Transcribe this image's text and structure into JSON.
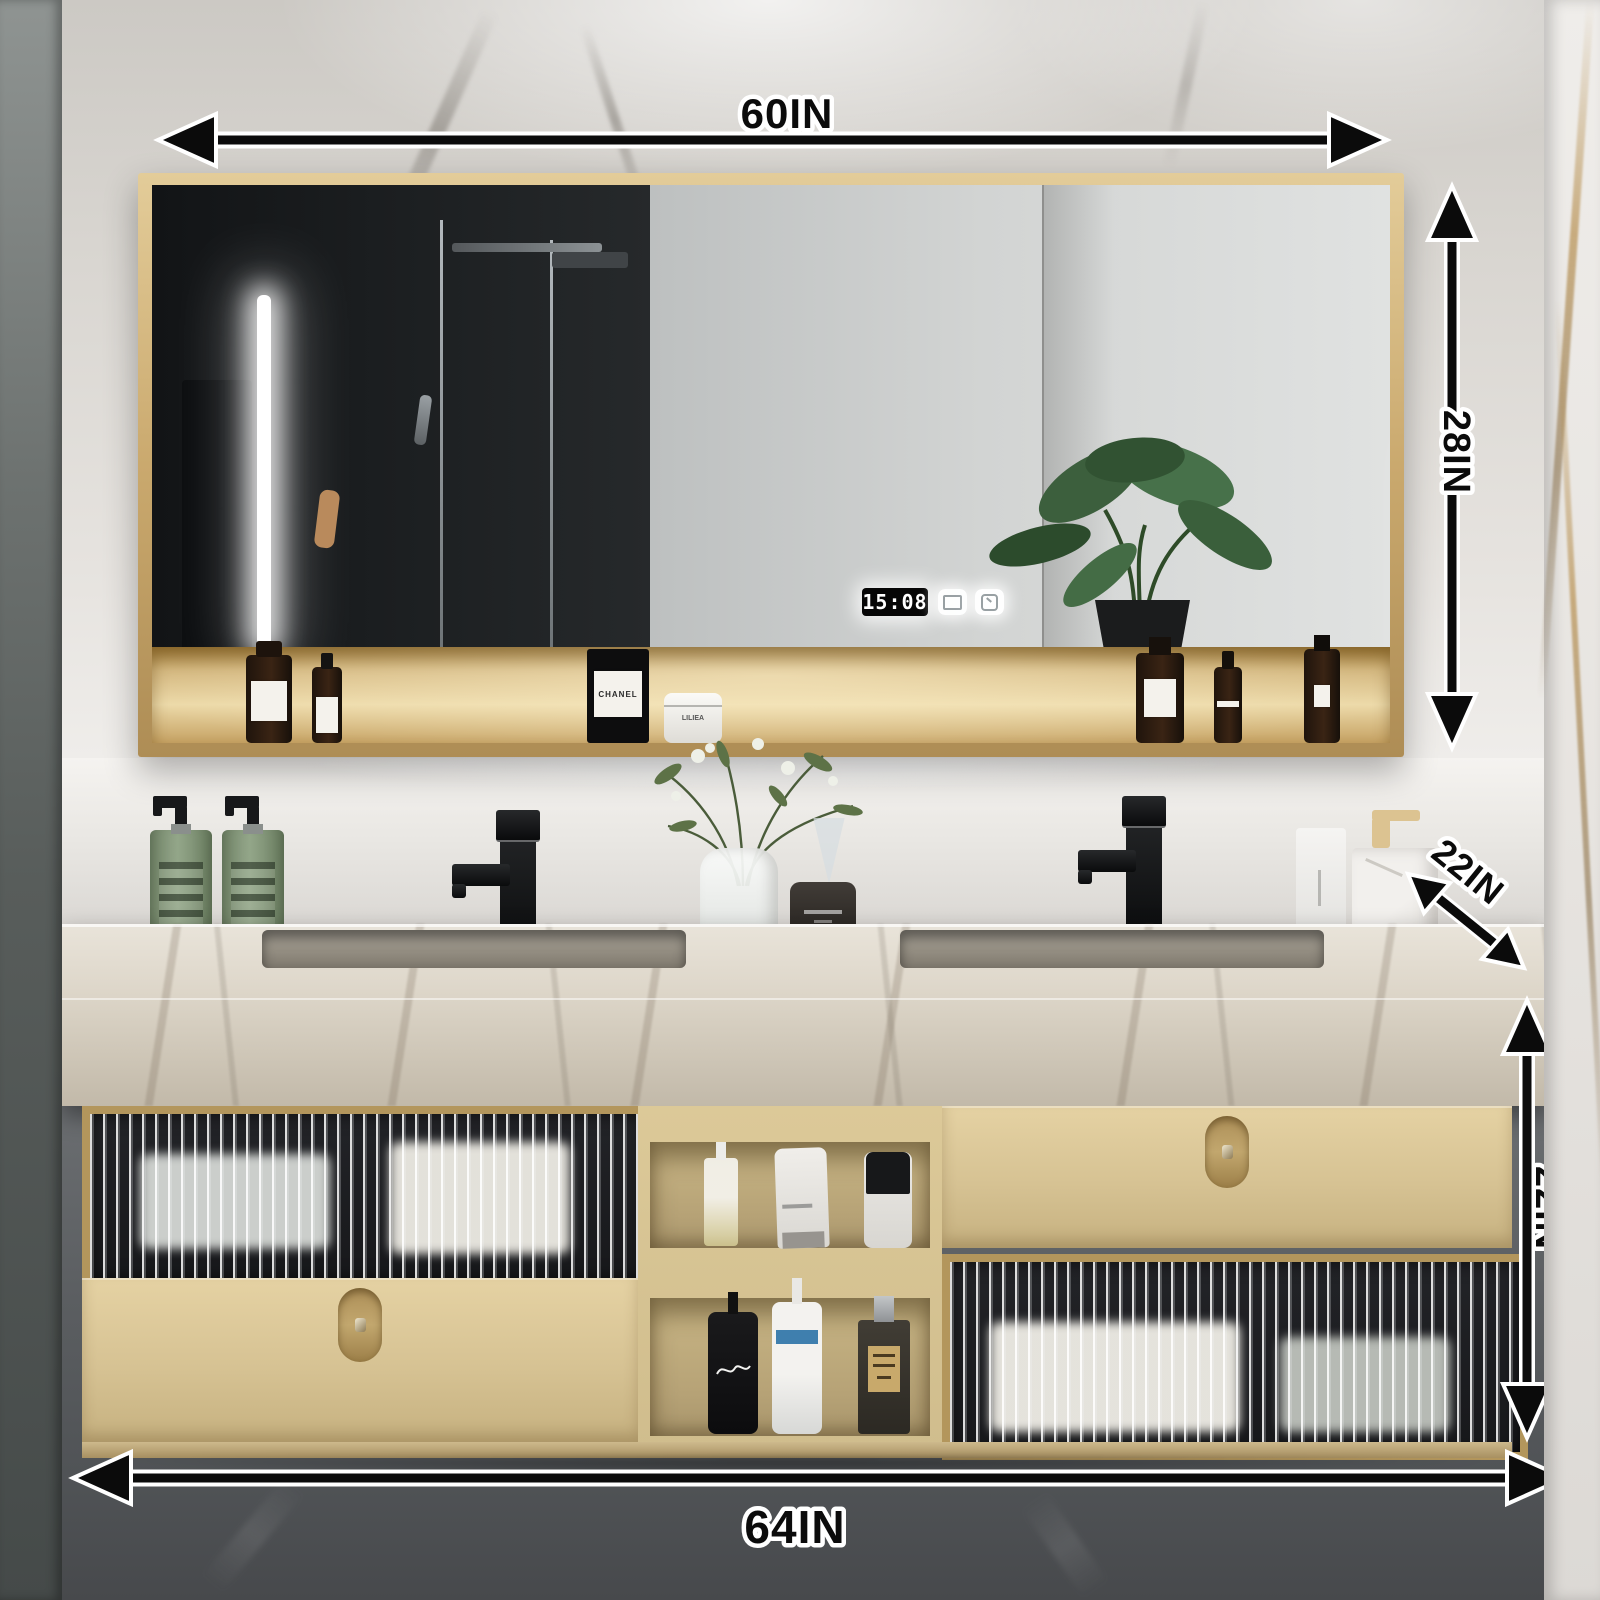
{
  "scene": {
    "description": "Bathroom vanity product photo with dimension annotations"
  },
  "dimensions": {
    "mirror_width": "60IN",
    "mirror_height": "28IN",
    "counter_depth": "22IN",
    "cabinet_height": "22IN",
    "vanity_width": "64IN"
  },
  "smart_mirror": {
    "clock_time": "15:08",
    "touch_icons": [
      "defog-icon",
      "light-dimmer-icon"
    ]
  },
  "shelf_products": {
    "candle_brand": "CHANEL",
    "jar_brand": "LILIEA"
  },
  "colors": {
    "gold_frame": "#c2a265",
    "cabinet_beige": "#dcc89a",
    "annotation_ink": "#0b0b0b",
    "annotation_outline": "#ffffff",
    "led_white": "#ffffff",
    "marble_light": "#e3e0dc",
    "wall_dark": "#5a5d60",
    "plant_green": "#3c5f3d",
    "soap_green": "#8fa387"
  }
}
